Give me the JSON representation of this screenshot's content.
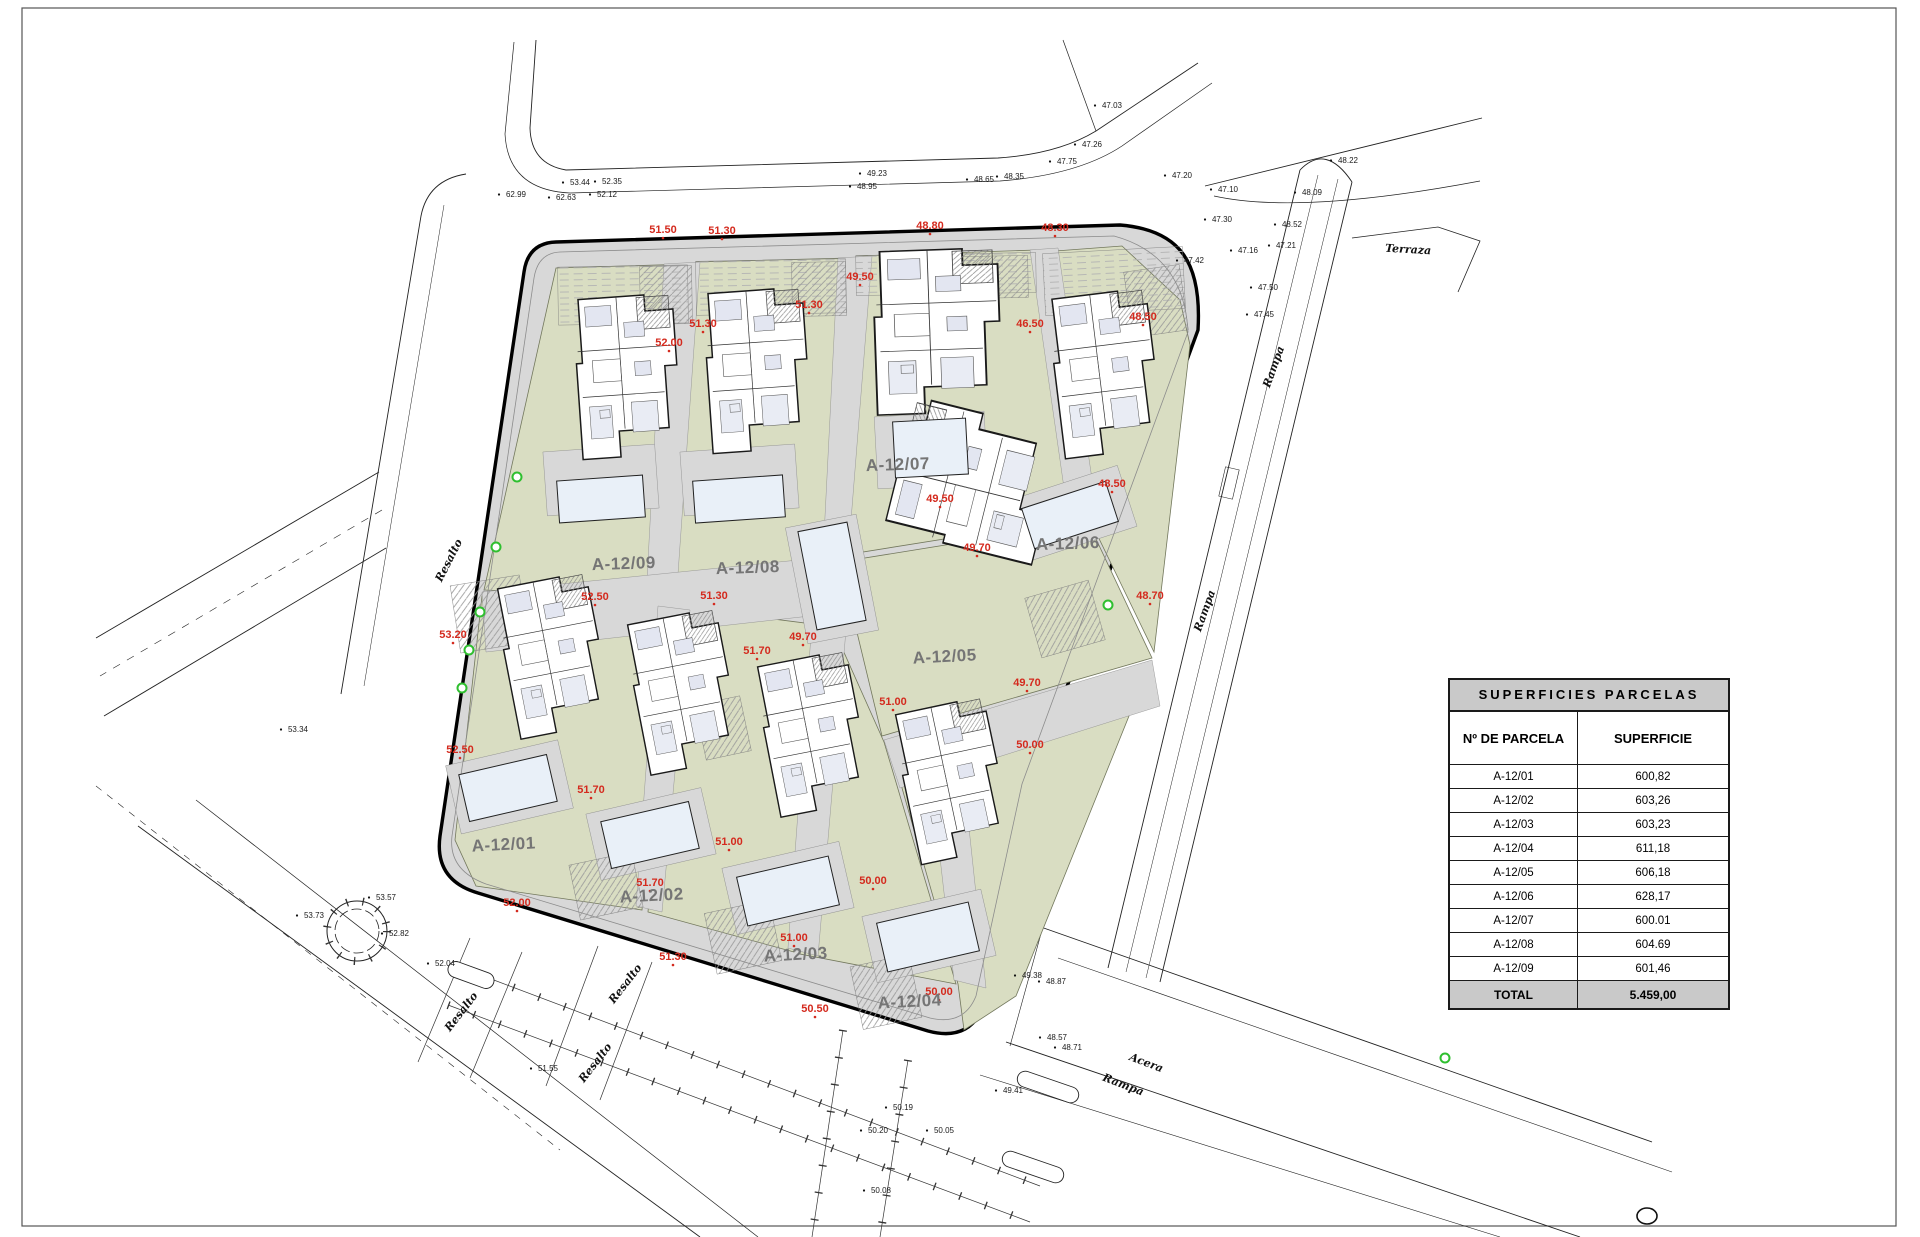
{
  "table": {
    "title": "SUPERFICIES PARCELAS",
    "columns": [
      "Nº DE PARCELA",
      "SUPERFICIE"
    ],
    "rows": [
      [
        "A-12/01",
        "600,82"
      ],
      [
        "A-12/02",
        "603,26"
      ],
      [
        "A-12/03",
        "603,23"
      ],
      [
        "A-12/04",
        "611,18"
      ],
      [
        "A-12/05",
        "606,18"
      ],
      [
        "A-12/06",
        "628,17"
      ],
      [
        "A-12/07",
        "600.01"
      ],
      [
        "A-12/08",
        "604.69"
      ],
      [
        "A-12/09",
        "601,46"
      ],
      [
        "TOTAL",
        "5.459,00"
      ]
    ]
  },
  "drawing": {
    "parcel_labels": [
      [
        "A-12/01",
        504,
        850,
        -3
      ],
      [
        "A-12/02",
        652,
        901,
        -3
      ],
      [
        "A-12/03",
        796,
        960,
        -3
      ],
      [
        "A-12/04",
        910,
        1007,
        -3
      ],
      [
        "A-12/05",
        945,
        662,
        -3
      ],
      [
        "A-12/06",
        1068,
        549,
        -2
      ],
      [
        "A-12/07",
        898,
        470,
        -2
      ],
      [
        "A-12/08",
        748,
        573,
        -2
      ],
      [
        "A-12/09",
        624,
        569,
        -2
      ]
    ],
    "red_labels": [
      [
        "51.50",
        663,
        233
      ],
      [
        "51.30",
        722,
        234
      ],
      [
        "48.80",
        930,
        229
      ],
      [
        "48.30",
        1055,
        231
      ],
      [
        "49.50",
        860,
        280
      ],
      [
        "51.30",
        809,
        308
      ],
      [
        "51.30",
        703,
        327
      ],
      [
        "52.00",
        669,
        346
      ],
      [
        "46.50",
        1030,
        327
      ],
      [
        "48.50",
        1143,
        320
      ],
      [
        "49.50",
        940,
        502
      ],
      [
        "48.50",
        1112,
        487
      ],
      [
        "52.50",
        595,
        600
      ],
      [
        "51.30",
        714,
        599
      ],
      [
        "49.70",
        977,
        551
      ],
      [
        "49.70",
        803,
        640
      ],
      [
        "48.70",
        1150,
        599
      ],
      [
        "51.70",
        757,
        654
      ],
      [
        "49.70",
        1027,
        686
      ],
      [
        "51.00",
        893,
        705
      ],
      [
        "53.20",
        453,
        638
      ],
      [
        "52.50",
        460,
        753
      ],
      [
        "51.70",
        591,
        793
      ],
      [
        "50.00",
        1030,
        748
      ],
      [
        "51.70",
        650,
        886
      ],
      [
        "51.00",
        729,
        845
      ],
      [
        "50.00",
        873,
        884
      ],
      [
        "52.00",
        517,
        906
      ],
      [
        "51.30",
        673,
        960
      ],
      [
        "51.00",
        794,
        941
      ],
      [
        "50.00",
        939,
        995
      ],
      [
        "50.50",
        815,
        1012
      ]
    ],
    "black_labels": [
      [
        "62.99",
        516,
        197
      ],
      [
        "62.63",
        566,
        200
      ],
      [
        "53.44",
        580,
        185
      ],
      [
        "52.35",
        612,
        184
      ],
      [
        "52.12",
        607,
        197
      ],
      [
        "49.23",
        877,
        176
      ],
      [
        "48.95",
        867,
        189
      ],
      [
        "48.65",
        984,
        182
      ],
      [
        "48.35",
        1014,
        179
      ],
      [
        "47.75",
        1067,
        164
      ],
      [
        "47.03",
        1112,
        108
      ],
      [
        "47.26",
        1092,
        147
      ],
      [
        "48.22",
        1348,
        163
      ],
      [
        "47.20",
        1182,
        178
      ],
      [
        "47.10",
        1228,
        192
      ],
      [
        "48.09",
        1312,
        195
      ],
      [
        "47.30",
        1222,
        222
      ],
      [
        "48.52",
        1292,
        227
      ],
      [
        "47.21",
        1286,
        248
      ],
      [
        "47.16",
        1248,
        253
      ],
      [
        "47.42",
        1194,
        263
      ],
      [
        "47.50",
        1268,
        290
      ],
      [
        "47.45",
        1264,
        317
      ],
      [
        "53.34",
        298,
        732
      ],
      [
        "53.57",
        386,
        900
      ],
      [
        "53.73",
        314,
        918
      ],
      [
        "52.82",
        399,
        936
      ],
      [
        "52.04",
        445,
        966
      ],
      [
        "51.55",
        548,
        1071
      ],
      [
        "49.38",
        1032,
        978
      ],
      [
        "48.87",
        1056,
        984
      ],
      [
        "48.57",
        1057,
        1040
      ],
      [
        "48.71",
        1072,
        1050
      ],
      [
        "49.41",
        1013,
        1093
      ],
      [
        "50.19",
        903,
        1110
      ],
      [
        "50.20",
        878,
        1133
      ],
      [
        "50.05",
        944,
        1133
      ],
      [
        "50.08",
        881,
        1193
      ]
    ],
    "street_labels": [
      [
        "Resalto",
        452,
        562,
        -63
      ],
      [
        "Resalto",
        464,
        1014,
        -52
      ],
      [
        "Resalto",
        628,
        986,
        -52
      ],
      [
        "Resalto",
        598,
        1065,
        -52
      ],
      [
        "Rampa",
        1277,
        368,
        -70
      ],
      [
        "Rampa",
        1208,
        612,
        -70
      ],
      [
        "Terraza",
        1408,
        253,
        3
      ],
      [
        "Acera",
        1145,
        1066,
        21
      ],
      [
        "Rampa",
        1122,
        1088,
        21
      ]
    ],
    "green_markers": [
      [
        517,
        477
      ],
      [
        496,
        547
      ],
      [
        480,
        612
      ],
      [
        469,
        650
      ],
      [
        462,
        688
      ],
      [
        1108,
        605
      ],
      [
        1445,
        1058
      ]
    ]
  },
  "colors": {
    "red_label": "#d42a1e",
    "parcel_green": "#d9ddc2",
    "paving_gray": "#d8d8d8",
    "pool_blue": "#e9f0f8",
    "marker_green": "#2fbf2f",
    "table_band_gray": "#c9c9c9"
  }
}
